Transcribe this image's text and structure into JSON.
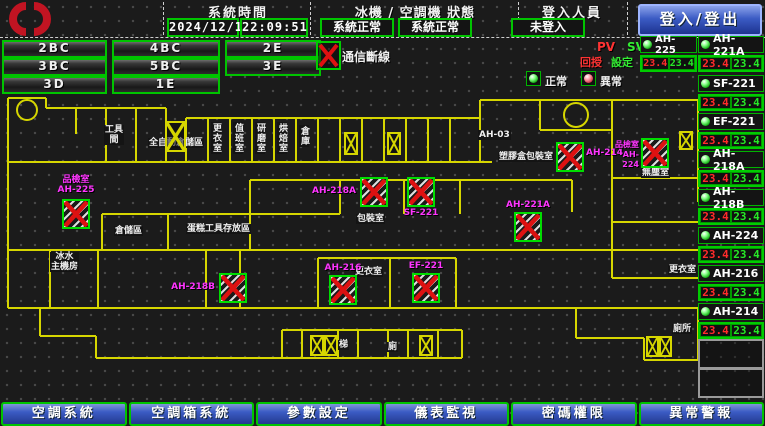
{
  "header": {
    "brand": "宏亞食品",
    "brand_sub": "HUNYA FOODS",
    "system_time_label": "系統時間",
    "date": "2024/12/12",
    "time": "22:09:51",
    "machine_status_label": "冰機 / 空調機 狀態",
    "chiller_status": "系統正常",
    "ac_status": "系統正常",
    "login_label": "登入人員",
    "login_status": "未登入",
    "login_button": "登入/登出"
  },
  "floor_buttons": [
    "2BC",
    "4BC",
    "2E",
    "3BC",
    "5BC",
    "3E",
    "3D",
    "1E"
  ],
  "legend": {
    "comm_offline": "通信斷線",
    "pv": "PV",
    "sv": "SV",
    "pv_sub": "回授",
    "sv_sub": "設定",
    "normal": "正常",
    "abnormal": "異常"
  },
  "colors": {
    "accent_green": "#00c400",
    "wall_yellow": "#d6d600",
    "alarm_red": "#dd1111",
    "magenta": "#ff35ff",
    "blue_button": "#3b5bc4"
  },
  "sidebar": {
    "devices": [
      {
        "name": "AH-225",
        "pv": "23.4",
        "sv": "23.4",
        "status": "normal"
      },
      {
        "name": "AH-221A",
        "pv": "23.4",
        "sv": "23.4",
        "status": "normal"
      },
      {
        "name": "SF-221",
        "pv": "23.4",
        "sv": "23.4",
        "status": "normal"
      },
      {
        "name": "EF-221",
        "pv": "23.4",
        "sv": "23.4",
        "status": "normal"
      },
      {
        "name": "AH-218A",
        "pv": "23.4",
        "sv": "23.4",
        "status": "normal"
      },
      {
        "name": "AH-218B",
        "pv": "23.4",
        "sv": "23.4",
        "status": "normal"
      },
      {
        "name": "AH-224",
        "pv": "23.4",
        "sv": "23.4",
        "status": "normal"
      },
      {
        "name": "AH-216",
        "pv": "23.4",
        "sv": "23.4",
        "status": "normal"
      },
      {
        "name": "AH-214",
        "pv": "23.4",
        "sv": "23.4",
        "status": "normal"
      }
    ],
    "empty_slots": 2
  },
  "map": {
    "rooms": [
      {
        "text": "工具\n間",
        "x": 104,
        "y": 33,
        "v": false
      },
      {
        "text": "全自動倉儲區",
        "x": 148,
        "y": 46,
        "v": false
      },
      {
        "text": "更衣室",
        "x": 211,
        "y": 30,
        "v": true
      },
      {
        "text": "值班室",
        "x": 233,
        "y": 30,
        "v": true
      },
      {
        "text": "研磨室",
        "x": 255,
        "y": 30,
        "v": true
      },
      {
        "text": "烘焙室",
        "x": 277,
        "y": 30,
        "v": true
      },
      {
        "text": "倉庫",
        "x": 299,
        "y": 33,
        "v": true
      },
      {
        "text": "AH-03",
        "x": 478,
        "y": 38,
        "v": false
      },
      {
        "text": "塑膠盒包裝室",
        "x": 498,
        "y": 60,
        "v": false
      },
      {
        "text": "無塵室",
        "x": 641,
        "y": 76,
        "v": false
      },
      {
        "text": "包裝室",
        "x": 356,
        "y": 122,
        "v": false
      },
      {
        "text": "倉儲區",
        "x": 114,
        "y": 134,
        "v": false
      },
      {
        "text": "蛋糕工具存放區",
        "x": 186,
        "y": 132,
        "v": false
      },
      {
        "text": "冰水\n主機房",
        "x": 50,
        "y": 160,
        "v": false
      },
      {
        "text": "更衣室",
        "x": 354,
        "y": 175,
        "v": false
      },
      {
        "text": "更衣室",
        "x": 668,
        "y": 173,
        "v": false
      },
      {
        "text": "廁所",
        "x": 672,
        "y": 232,
        "v": false
      },
      {
        "text": "梯",
        "x": 338,
        "y": 248,
        "v": false
      },
      {
        "text": "廁",
        "x": 387,
        "y": 250,
        "v": false
      }
    ],
    "equipment": [
      {
        "name": "AH-225",
        "room": "品檢室",
        "x": 62,
        "y": 107,
        "label": "above"
      },
      {
        "name": "AH-218A",
        "x": 360,
        "y": 85,
        "label": "left"
      },
      {
        "name": "SF-221",
        "x": 407,
        "y": 85,
        "label": "below"
      },
      {
        "name": "AH-214",
        "x": 556,
        "y": 50,
        "label": "right"
      },
      {
        "name": "AH-224",
        "room": "品檢室",
        "x": 641,
        "y": 46,
        "label": "left2"
      },
      {
        "name": "AH-221A",
        "x": 514,
        "y": 120,
        "label": "above"
      },
      {
        "name": "AH-218B",
        "x": 219,
        "y": 181,
        "label": "left"
      },
      {
        "name": "AH-216",
        "x": 329,
        "y": 183,
        "label": "above"
      },
      {
        "name": "EF-221",
        "x": 412,
        "y": 181,
        "label": "above"
      }
    ],
    "stairs": [
      [
        165,
        29,
        21,
        31
      ],
      [
        344,
        40,
        14,
        23
      ],
      [
        387,
        40,
        14,
        23
      ],
      [
        679,
        39,
        14,
        19
      ],
      [
        310,
        243,
        14,
        21
      ],
      [
        324,
        243,
        14,
        21
      ],
      [
        419,
        243,
        14,
        21
      ],
      [
        646,
        244,
        13,
        21
      ],
      [
        659,
        244,
        13,
        21
      ]
    ]
  },
  "nav": {
    "buttons": [
      "空調系統",
      "空調箱系統",
      "參數設定",
      "儀表監視",
      "密碼權限",
      "異常警報"
    ]
  }
}
